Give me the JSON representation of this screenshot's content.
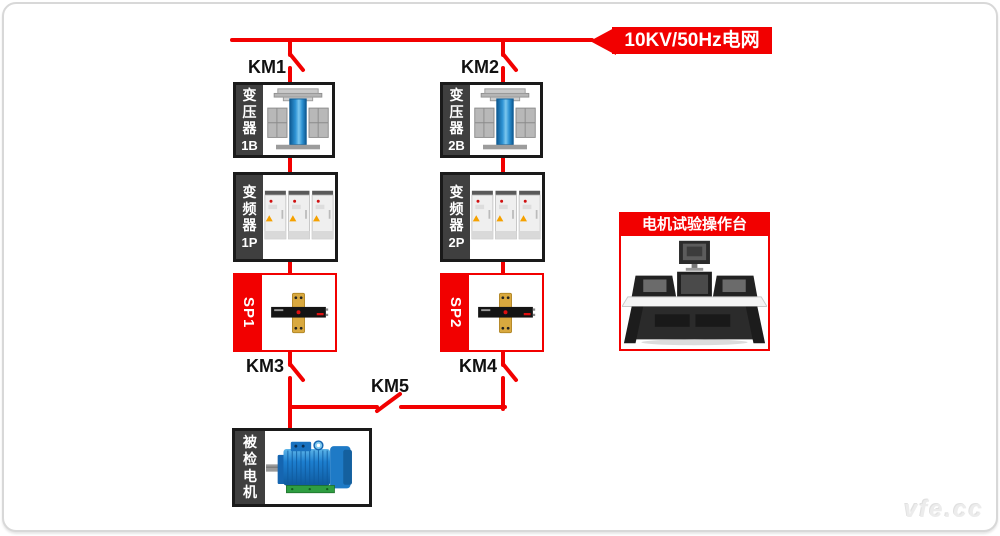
{
  "grid_banner": {
    "label": "10KV/50Hz电网"
  },
  "switches": {
    "km1": "KM1",
    "km2": "KM2",
    "km3": "KM3",
    "km4": "KM4",
    "km5": "KM5"
  },
  "branch1": {
    "transformer_name": "变压器",
    "transformer_code": "1B",
    "inverter_name": "变频器",
    "inverter_code": "1P",
    "sensor_code": "SP1"
  },
  "branch2": {
    "transformer_name": "变压器",
    "transformer_code": "2B",
    "inverter_name": "变频器",
    "inverter_code": "2P",
    "sensor_code": "SP2"
  },
  "motor": {
    "label": "被检电机"
  },
  "console": {
    "title": "电机试验操作台"
  },
  "watermark": {
    "text": "vfe.cc"
  },
  "colors": {
    "accent_red": "#f20000",
    "band_dark": "#3f3f3f",
    "box_border": "#1a1a1a",
    "motor_blue": "#1d7fd0",
    "busbar_gold": "#d9a93f"
  }
}
